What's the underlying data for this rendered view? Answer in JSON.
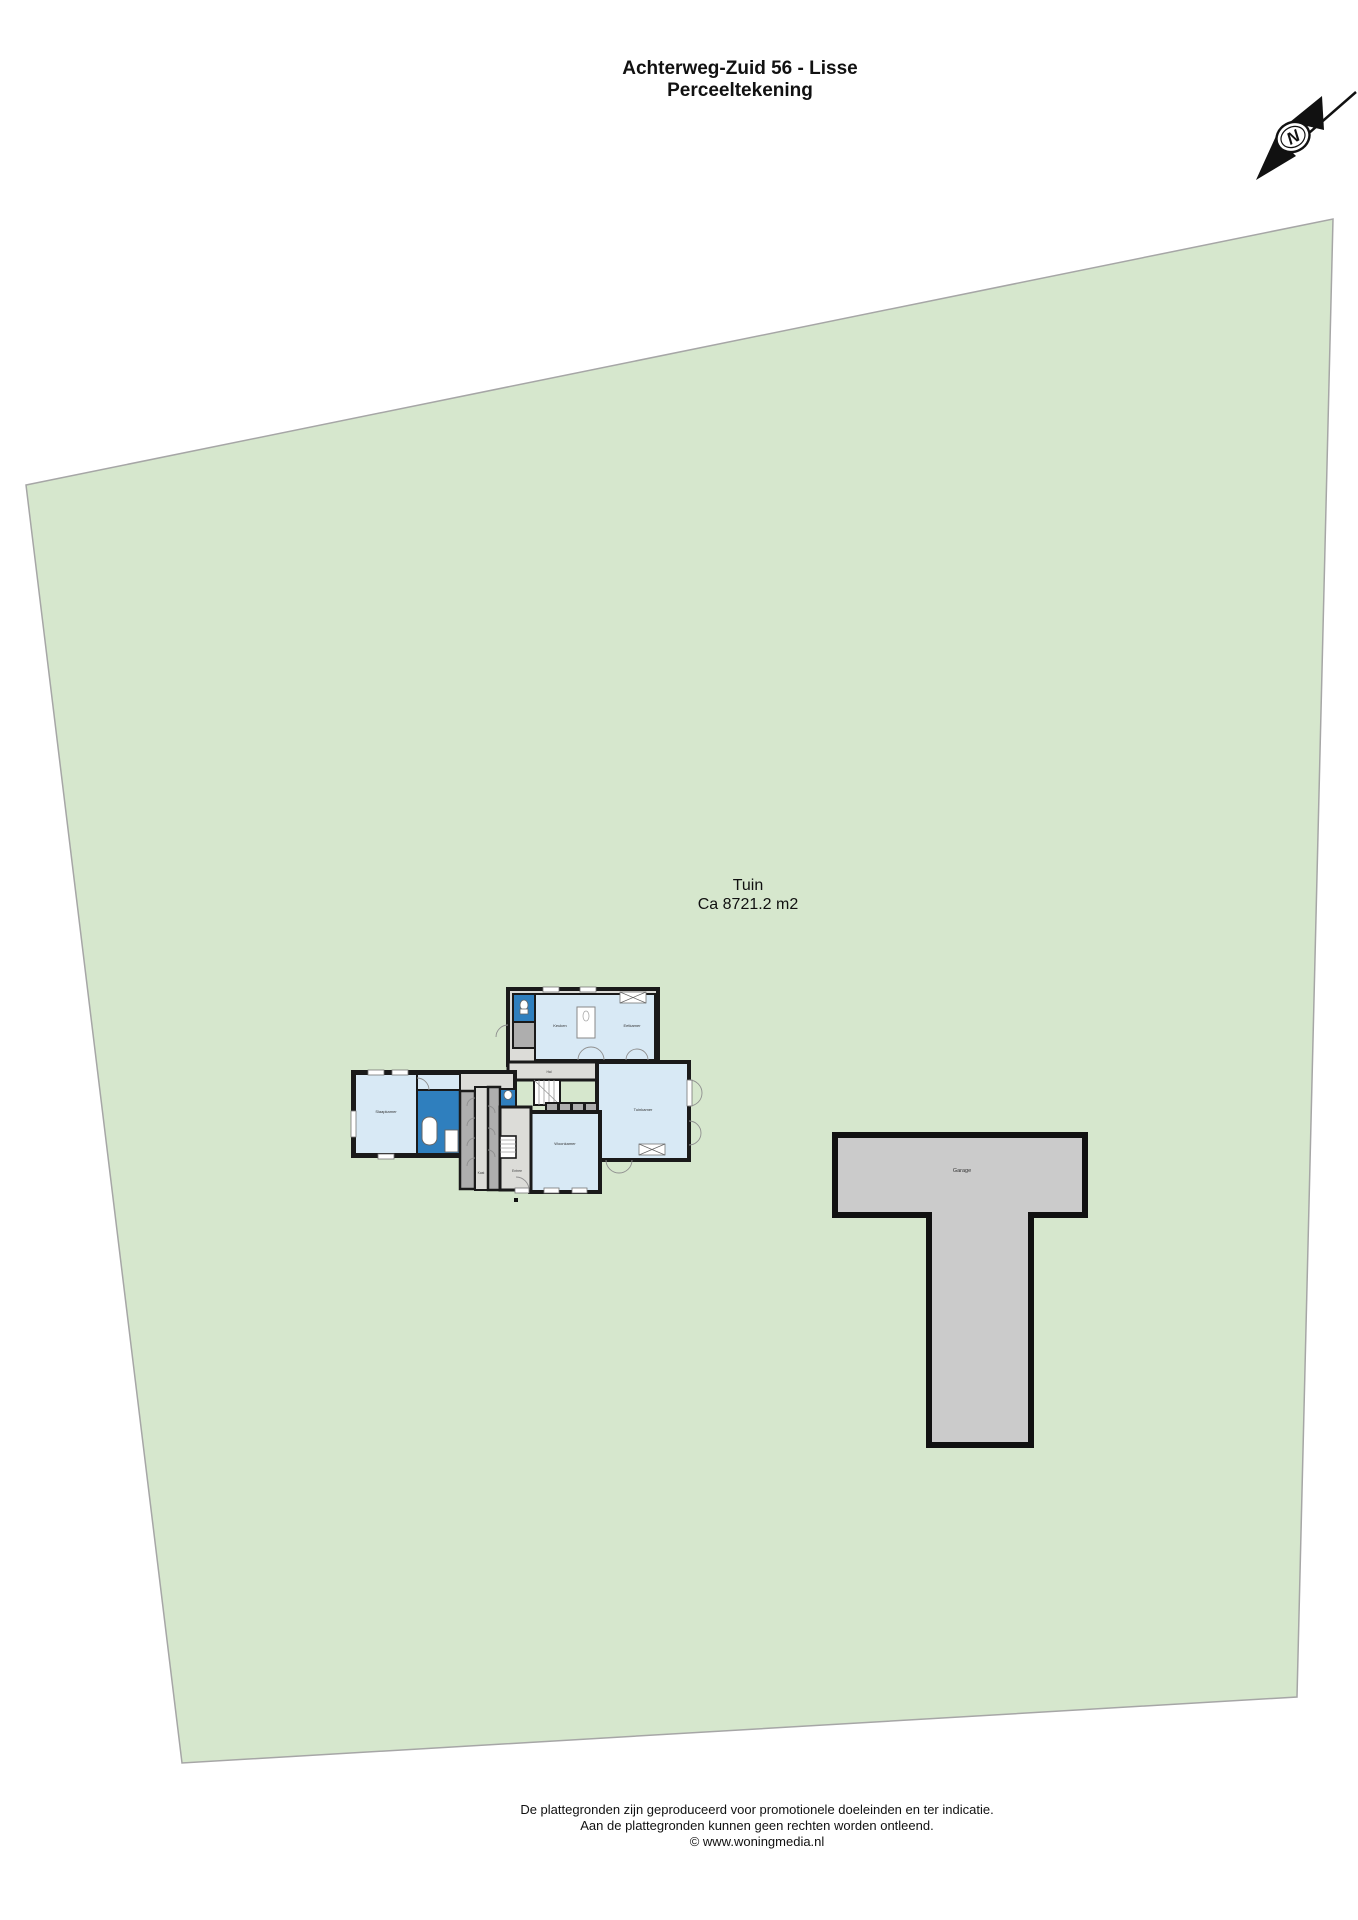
{
  "header": {
    "title_line1": "Achterweg-Zuid 56 - Lisse",
    "title_line2": "Perceeltekening"
  },
  "compass": {
    "north_label": "N"
  },
  "parcel": {
    "name": "Tuin",
    "area": "Ca 8721.2 m2"
  },
  "house": {
    "rooms": {
      "keuken": "Keuken",
      "eetkamer": "Eetkamer",
      "tuinkamer": "Tuinkamer",
      "woonkamer": "Woonkamer",
      "slaapkamer": "Slaapkamer",
      "hal": "Hal",
      "entree": "Entree",
      "kast": "Kast"
    }
  },
  "garage": {
    "label": "Garage"
  },
  "footer": {
    "line1": "De plattegronden zijn geproduceerd voor promotionele doeleinden en ter indicatie.",
    "line2": "Aan de plattegronden kunnen geen rechten worden ontleend.",
    "line3": "© www.woningmedia.nl"
  },
  "colors": {
    "parcel_green": "#d6e7cd",
    "parcel_border": "#a6a6a6",
    "garage_fill": "#cbcbcb",
    "wall_black": "#1a1a1a",
    "room_light_blue": "#d8e9f5",
    "room_dark_blue": "#2f7fbe",
    "hall_gray": "#aeaeae",
    "floor_light_gray": "#dcdcd8"
  }
}
